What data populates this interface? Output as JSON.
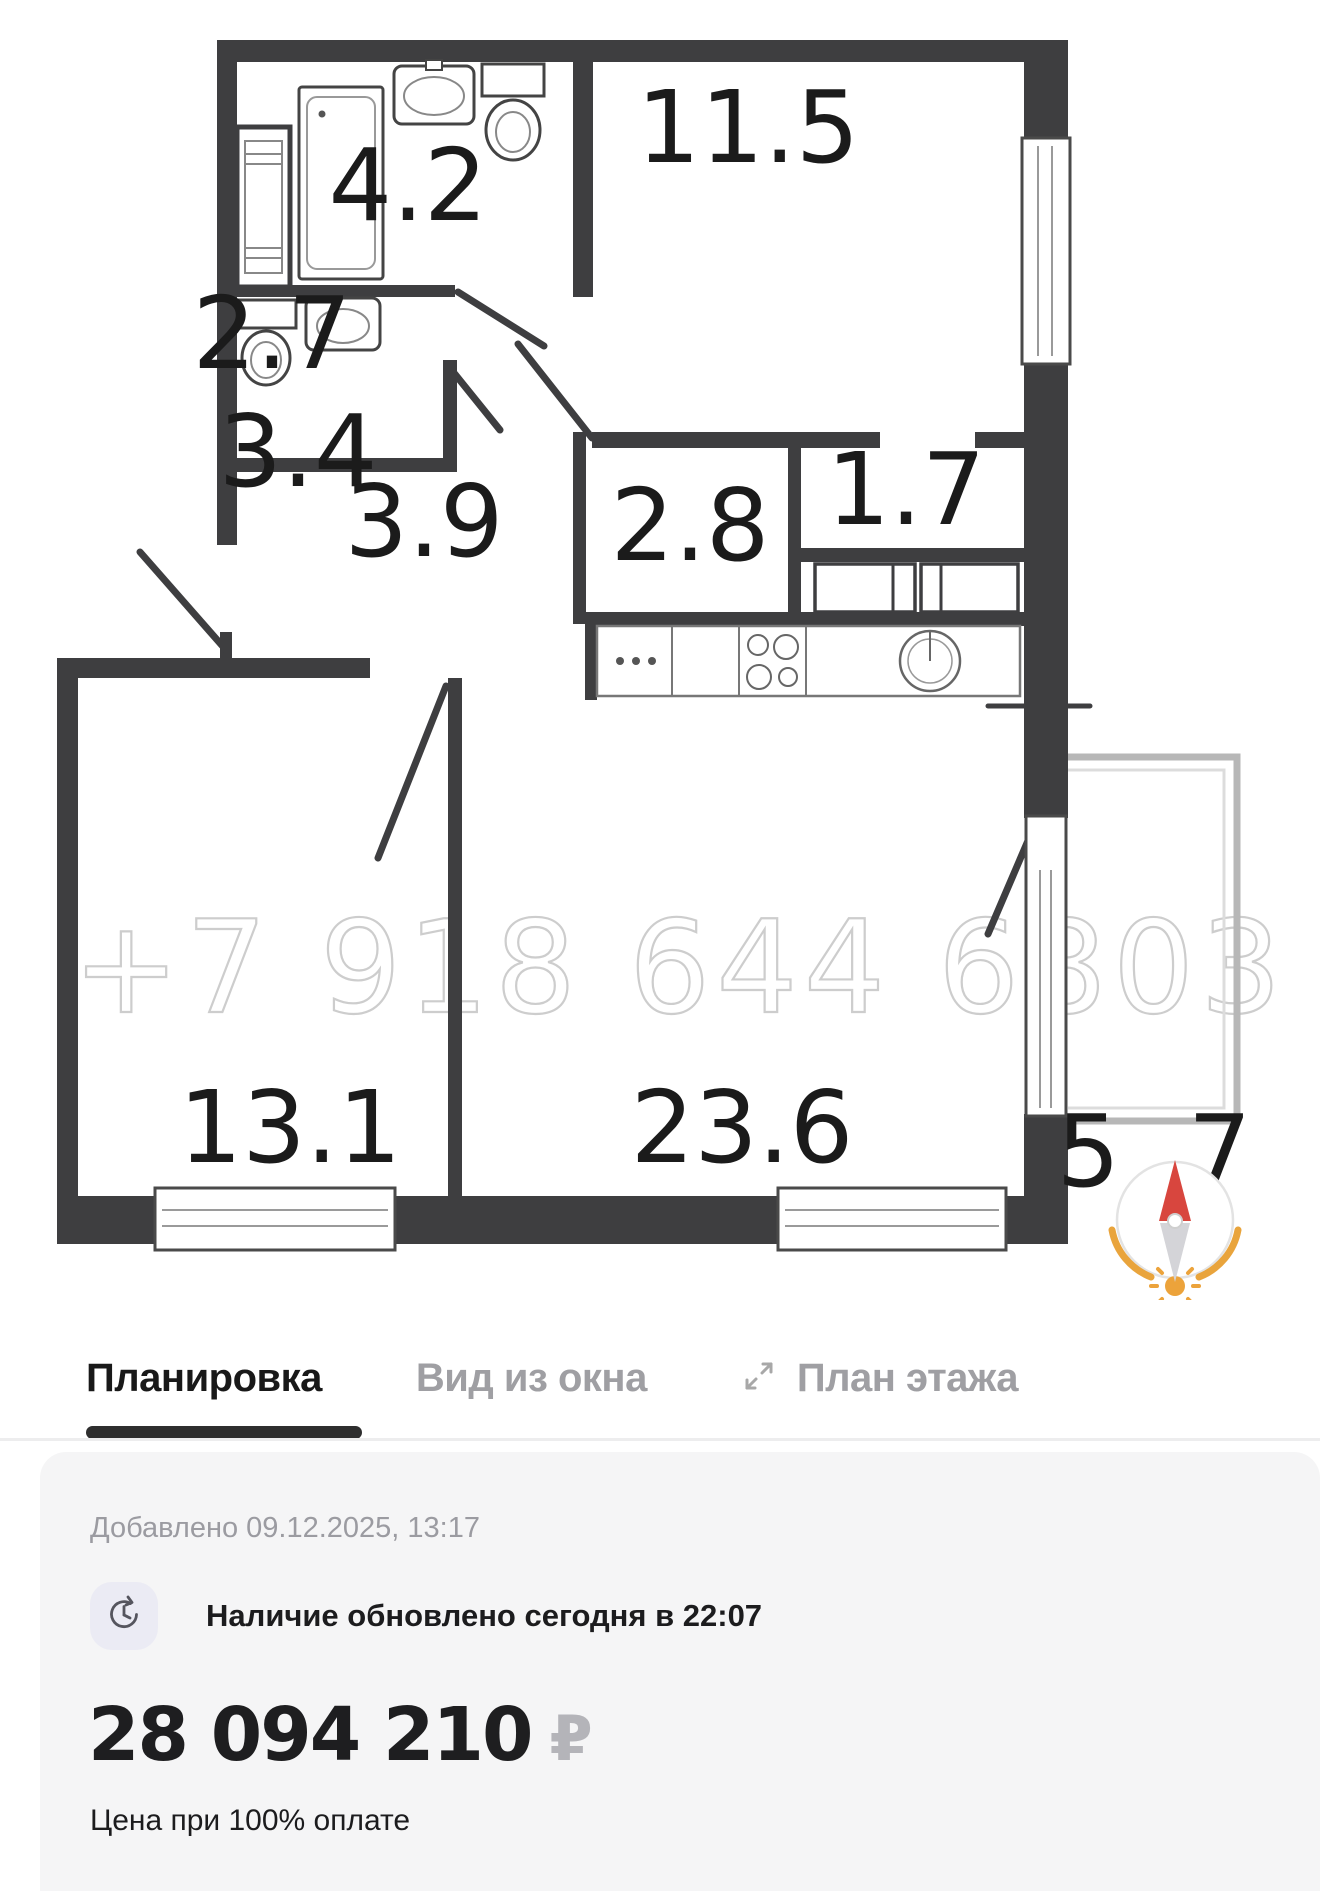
{
  "plan": {
    "watermark": "+7 918 644 6803",
    "rooms": {
      "bathroom": "4.2",
      "bedroom": "11.5",
      "wc": "2.7",
      "entry_hall": "3.4",
      "hallway": "3.9",
      "closet": "2.8",
      "wardrobe": "1.7",
      "room_second": "13.1",
      "living_kitchen": "23.6",
      "balcony": "5 7"
    },
    "compass": {
      "north_color": "#d8463e",
      "arc_color": "#e9a43c"
    }
  },
  "tabs": {
    "layout": "Планировка",
    "window_view": "Вид из окна",
    "floor_plan": "План этажа"
  },
  "listing": {
    "added": "Добавлено 09.12.2025, 13:17",
    "availability": "Наличие обновлено сегодня в 22:07",
    "price": "28 094 210",
    "currency": "₽",
    "price_note": "Цена при 100% оплате"
  }
}
